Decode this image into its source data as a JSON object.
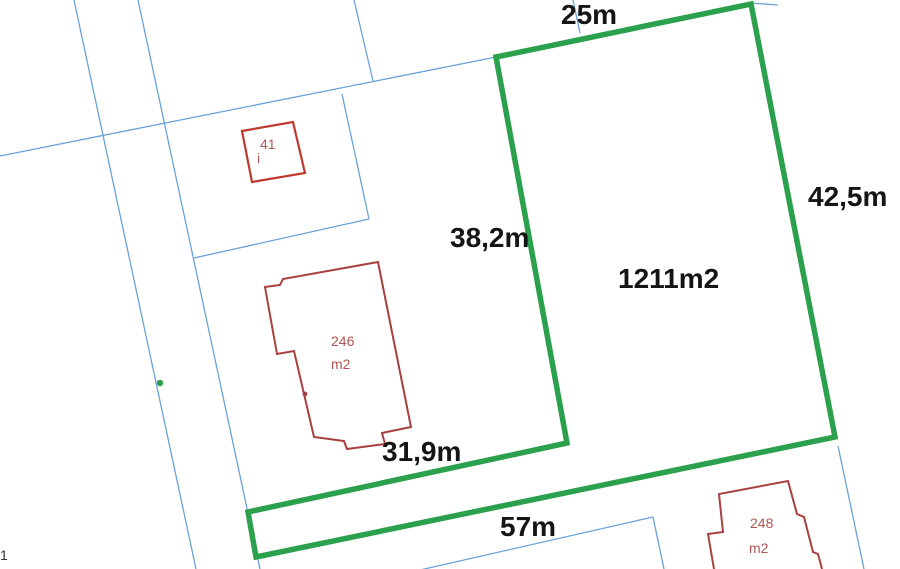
{
  "parcel": {
    "area_label": "1211m2",
    "dimensions": {
      "top": "25m",
      "right": "42,5m",
      "left": "38,2m",
      "bottom_inner": "31,9m",
      "bottom_strip": "57m"
    }
  },
  "buildings": [
    {
      "number": "41",
      "note": "i"
    },
    {
      "number": "246",
      "unit": "m2"
    },
    {
      "number": "248",
      "unit": "m2"
    }
  ],
  "misc": {
    "corner_mark": "1"
  },
  "colors": {
    "green": "#2ba04d",
    "blue": "#6aa2d6",
    "red-bright": "#c0392f",
    "red-dark": "#a8403f",
    "red-text": "#b05551",
    "label": "#151515",
    "bg": "#ffffff"
  }
}
